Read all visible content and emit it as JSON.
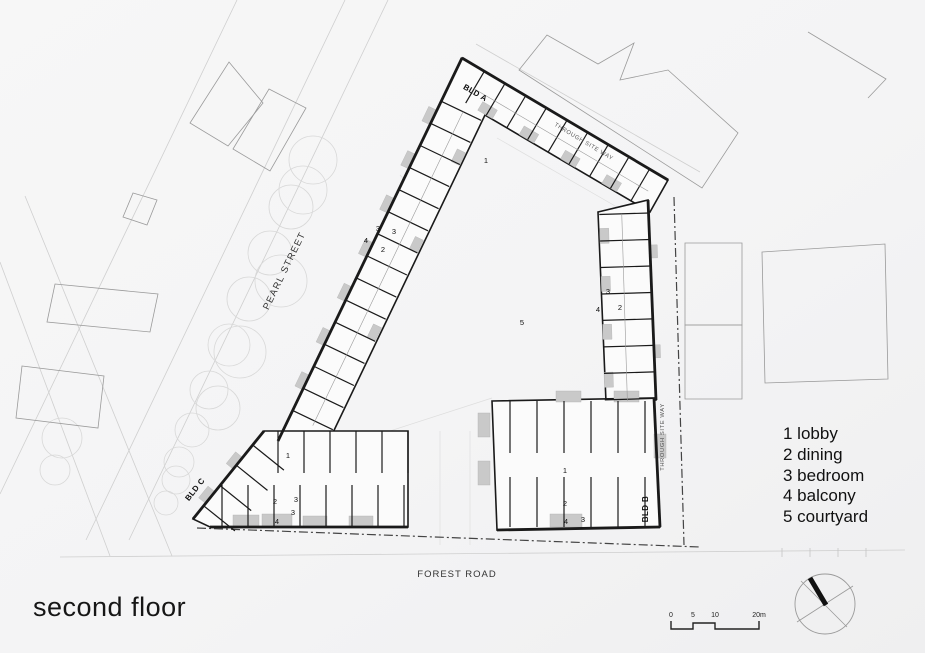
{
  "sheet": {
    "title": "second floor"
  },
  "legend": {
    "items": [
      "1 lobby",
      "2 dining",
      "3 bedroom",
      "4 balcony",
      "5 courtyard"
    ]
  },
  "scale_bar": {
    "labels": [
      "0",
      "5",
      "10",
      "20m"
    ],
    "xs": [
      671,
      693,
      715,
      759
    ],
    "label_y": 617,
    "path": "M671,621 L671,629 L693,629 L693,623 L715,623 L715,629 L759,629 L759,621"
  },
  "compass": {
    "cx": 825,
    "cy": 604,
    "r": 30,
    "thin": [
      [
        797,
        622,
        853,
        586
      ],
      [
        801,
        581,
        847,
        627
      ]
    ],
    "thick": [
      810,
      578,
      826,
      605
    ]
  },
  "plan": {
    "colors": {
      "wall": "#1a1a1a",
      "light": "#cfcfcf",
      "context": "#9a9a9a",
      "balcony": "#c9c9c9",
      "fill": "#fbfbfb"
    },
    "street_lines": [
      [
        388,
        0,
        129,
        540
      ],
      [
        345,
        0,
        86,
        540
      ],
      [
        237,
        0,
        0,
        494
      ],
      [
        25,
        196,
        172,
        556
      ],
      [
        0,
        262,
        110,
        556
      ],
      [
        476,
        44,
        700,
        172
      ],
      [
        60,
        557,
        905,
        550
      ]
    ],
    "courtyard_lines": [
      [
        497,
        138,
        636,
        218
      ],
      [
        636,
        218,
        644,
        390
      ],
      [
        356,
        442,
        492,
        398
      ],
      [
        408,
        445,
        356,
        442
      ],
      [
        410,
        160,
        445,
        198
      ],
      [
        400,
        175,
        435,
        213
      ],
      [
        440,
        431,
        440,
        545
      ],
      [
        470,
        431,
        470,
        545
      ]
    ],
    "boundary": [
      [
        674,
        197,
        684,
        545
      ],
      [
        197,
        528,
        700,
        547
      ]
    ],
    "ticks": [
      [
        782,
        548,
        782,
        557
      ],
      [
        810,
        548,
        810,
        557
      ],
      [
        838,
        548,
        838,
        557
      ],
      [
        866,
        548,
        866,
        557
      ]
    ],
    "trees": [
      [
        313,
        160,
        24
      ],
      [
        303,
        190,
        24
      ],
      [
        291,
        207,
        22
      ],
      [
        281,
        281,
        26
      ],
      [
        270,
        253,
        22
      ],
      [
        249,
        299,
        22
      ],
      [
        240,
        352,
        26
      ],
      [
        229,
        345,
        21
      ],
      [
        209,
        390,
        19
      ],
      [
        218,
        408,
        22
      ],
      [
        192,
        430,
        17
      ],
      [
        179,
        462,
        15
      ],
      [
        176,
        480,
        14
      ],
      [
        166,
        503,
        12
      ],
      [
        62,
        438,
        20
      ],
      [
        55,
        470,
        15
      ]
    ],
    "context": [
      {
        "pts": "229,62 263,103 228,146 190,123",
        "close": true
      },
      {
        "pts": "269,89 306,108 270,171 233,149",
        "close": true
      },
      {
        "pts": "133,193 157,200 147,225 123,217",
        "close": true
      },
      {
        "pts": "55,284 158,294 150,332 47,322",
        "close": true
      },
      {
        "pts": "22,366 104,376 98,428 16,418",
        "close": true
      },
      {
        "pts": "519,70 547,35 598,64 634,43 620,80 668,70 738,133 702,188",
        "close": true
      },
      {
        "pts": "808,32 886,79 868,98",
        "close": false
      },
      {
        "pts": "762,252 885,244 888,379 765,383",
        "close": true
      },
      {
        "pts": "685,243 742,243 742,325 685,325",
        "close": true
      },
      {
        "pts": "685,325 742,325 742,399 685,399",
        "close": true
      }
    ],
    "footprints": [
      {
        "name": "bld-a-wing",
        "pts": "462,58 668,180 650,212 485,115 327,445 278,441"
      },
      {
        "name": "right-wing",
        "pts": "598,212 648,200 656,400 606,402"
      },
      {
        "name": "bld-b",
        "pts": "492,401 654,398 660,527 497,530"
      },
      {
        "name": "bld-c",
        "pts": "264,431 408,431 408,527 210,527 193,519"
      }
    ],
    "thick_edges": [
      [
        462,
        58,
        668,
        180
      ],
      [
        462,
        58,
        278,
        441
      ],
      [
        648,
        200,
        656,
        400
      ],
      [
        654,
        398,
        660,
        527
      ],
      [
        264,
        431,
        193,
        519
      ],
      [
        210,
        527,
        408,
        527
      ],
      [
        497,
        530,
        660,
        527
      ]
    ],
    "wings": [
      {
        "x": 462,
        "y": 58,
        "ux": -0.432,
        "uy": 0.902,
        "nx": 0.902,
        "ny": 0.432,
        "w": 44,
        "t0": 48,
        "t1": 396,
        "step": 24.5,
        "mid": true
      },
      {
        "x": 462,
        "y": 58,
        "ux": 0.862,
        "uy": 0.507,
        "nx": -0.507,
        "ny": 0.862,
        "w": 37,
        "t0": 26,
        "t1": 228,
        "step": 24,
        "mid": true
      },
      {
        "x": 649,
        "y": 205,
        "ux": 0.03,
        "uy": 0.9995,
        "nx": -0.9995,
        "ny": 0.03,
        "w": 50,
        "t0": 8,
        "t1": 195,
        "step": 26.5,
        "mid": true
      },
      {
        "x": 492,
        "y": 401,
        "ux": 1,
        "uy": 0,
        "nx": 0,
        "ny": 1,
        "w": 52,
        "t0": 18,
        "t1": 162,
        "step": 27
      },
      {
        "x": 492,
        "y": 527,
        "ux": 1,
        "uy": 0,
        "nx": 0,
        "ny": -1,
        "w": 50,
        "t0": 18,
        "t1": 162,
        "step": 27
      },
      {
        "x": 264,
        "y": 431,
        "ux": 1,
        "uy": 0,
        "nx": 0,
        "ny": 1,
        "w": 42,
        "t0": 14,
        "t1": 144,
        "step": 26
      },
      {
        "x": 210,
        "y": 527,
        "ux": 1,
        "uy": 0,
        "nx": 0,
        "ny": -1,
        "w": 42,
        "t0": 12,
        "t1": 198,
        "step": 26
      },
      {
        "x": 264,
        "y": 431,
        "ux": -0.628,
        "uy": 0.779,
        "nx": 0.779,
        "ny": 0.628,
        "w": 40,
        "t0": 18,
        "t1": 108,
        "step": 26
      }
    ],
    "balconies_wing": [
      {
        "w": 0,
        "t": 58,
        "len": 16,
        "d": 9,
        "side": "out"
      },
      {
        "w": 0,
        "t": 107,
        "len": 16,
        "d": 9,
        "side": "out"
      },
      {
        "w": 0,
        "t": 156,
        "len": 16,
        "d": 9,
        "side": "out"
      },
      {
        "w": 0,
        "t": 205,
        "len": 16,
        "d": 9,
        "side": "out"
      },
      {
        "w": 0,
        "t": 254,
        "len": 16,
        "d": 9,
        "side": "out"
      },
      {
        "w": 0,
        "t": 303,
        "len": 16,
        "d": 9,
        "side": "out"
      },
      {
        "w": 0,
        "t": 352,
        "len": 16,
        "d": 9,
        "side": "out"
      },
      {
        "w": 0,
        "t": 84,
        "len": 14,
        "d": 9,
        "side": "in"
      },
      {
        "w": 0,
        "t": 181,
        "len": 14,
        "d": 9,
        "side": "in"
      },
      {
        "w": 0,
        "t": 278,
        "len": 14,
        "d": 9,
        "side": "in"
      },
      {
        "w": 1,
        "t": 40,
        "len": 17,
        "d": 10,
        "side": "in"
      },
      {
        "w": 1,
        "t": 88,
        "len": 17,
        "d": 10,
        "side": "in"
      },
      {
        "w": 1,
        "t": 136,
        "len": 17,
        "d": 10,
        "side": "in"
      },
      {
        "w": 1,
        "t": 184,
        "len": 17,
        "d": 10,
        "side": "in"
      },
      {
        "w": 2,
        "t": 22,
        "len": 15,
        "d": 9,
        "side": "in"
      },
      {
        "w": 2,
        "t": 70,
        "len": 15,
        "d": 9,
        "side": "in"
      },
      {
        "w": 2,
        "t": 118,
        "len": 15,
        "d": 9,
        "side": "in"
      },
      {
        "w": 2,
        "t": 166,
        "len": 15,
        "d": 9,
        "side": "in"
      },
      {
        "w": 2,
        "t": 40,
        "len": 13,
        "d": 7,
        "side": "out"
      },
      {
        "w": 2,
        "t": 140,
        "len": 13,
        "d": 7,
        "side": "out"
      },
      {
        "w": 7,
        "t": 34,
        "len": 15,
        "d": 9,
        "side": "out"
      },
      {
        "w": 7,
        "t": 78,
        "len": 15,
        "d": 9,
        "side": "out"
      }
    ],
    "balconies_rect": [
      [
        478,
        413,
        12,
        24
      ],
      [
        478,
        461,
        12,
        24
      ],
      [
        556,
        391,
        25,
        11
      ],
      [
        614,
        391,
        25,
        11
      ],
      [
        550,
        514,
        32,
        13
      ],
      [
        654,
        434,
        12,
        24
      ],
      [
        233,
        515,
        26,
        12
      ],
      [
        262,
        514,
        30,
        13
      ],
      [
        303,
        516,
        24,
        11
      ],
      [
        349,
        516,
        24,
        11
      ]
    ],
    "room_numbers": [
      {
        "t": "1",
        "x": 288,
        "y": 458
      },
      {
        "t": "1",
        "x": 565,
        "y": 473
      },
      {
        "t": "1",
        "x": 486,
        "y": 163
      },
      {
        "t": "2",
        "x": 383,
        "y": 252
      },
      {
        "t": "2",
        "x": 620,
        "y": 310
      },
      {
        "t": "2",
        "x": 275,
        "y": 504
      },
      {
        "t": "2",
        "x": 565,
        "y": 506
      },
      {
        "t": "3",
        "x": 378,
        "y": 231
      },
      {
        "t": "3",
        "x": 394,
        "y": 234
      },
      {
        "t": "3",
        "x": 608,
        "y": 294
      },
      {
        "t": "3",
        "x": 296,
        "y": 502
      },
      {
        "t": "3",
        "x": 293,
        "y": 515
      },
      {
        "t": "3",
        "x": 583,
        "y": 522
      },
      {
        "t": "4",
        "x": 366,
        "y": 243
      },
      {
        "t": "4",
        "x": 598,
        "y": 312
      },
      {
        "t": "4",
        "x": 277,
        "y": 524
      },
      {
        "t": "4",
        "x": 566,
        "y": 524
      },
      {
        "t": "5",
        "x": 522,
        "y": 325
      }
    ],
    "labels": [
      {
        "t": "PEARL STREET",
        "x": 287,
        "y": 272,
        "r": -64,
        "s": 9.5,
        "ls": 1.2,
        "c": "#333",
        "b": false
      },
      {
        "t": "FOREST ROAD",
        "x": 457,
        "y": 577,
        "r": 0,
        "s": 9.5,
        "ls": 1,
        "c": "#333",
        "b": false
      },
      {
        "t": "THROUGH SITE WAY",
        "x": 583,
        "y": 143,
        "r": 31,
        "s": 5.8,
        "ls": 0.6,
        "c": "#555",
        "b": false
      },
      {
        "t": "THROUGH SITE WAY",
        "x": 664,
        "y": 437,
        "r": -90,
        "s": 5.8,
        "ls": 0.6,
        "c": "#555",
        "b": false
      },
      {
        "t": "BLD A",
        "x": 474,
        "y": 95,
        "r": 30,
        "s": 8,
        "ls": 0.4,
        "c": "#111",
        "b": true
      },
      {
        "t": "BLD B",
        "x": 648,
        "y": 509,
        "r": -90,
        "s": 8,
        "ls": 0.4,
        "c": "#111",
        "b": true
      },
      {
        "t": "BLD C",
        "x": 197,
        "y": 491,
        "r": -52,
        "s": 8,
        "ls": 0.4,
        "c": "#111",
        "b": true
      }
    ]
  }
}
